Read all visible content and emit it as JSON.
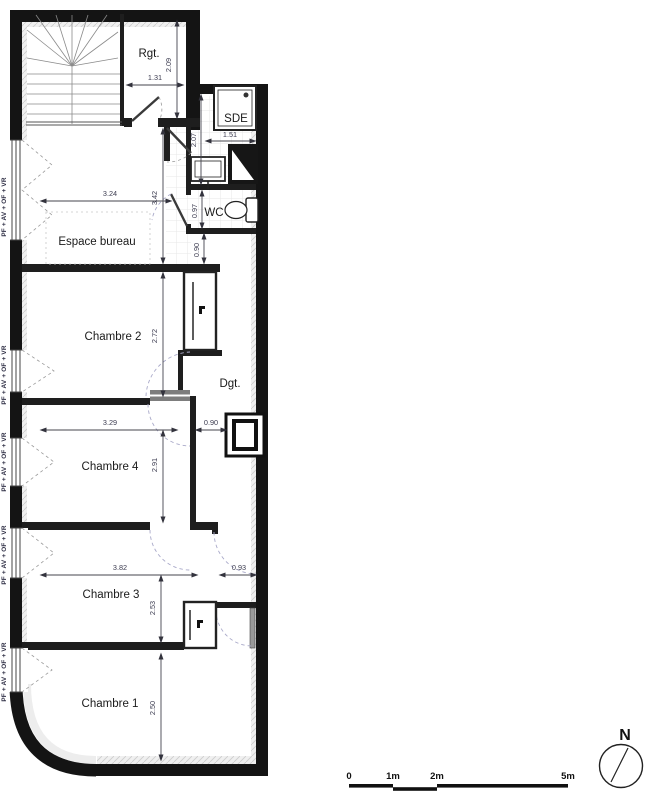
{
  "plan": {
    "room_labels": {
      "rgt": "Rgt.",
      "sde": "SDE",
      "wc": "WC",
      "bureau": "Espace bureau",
      "chambre2": "Chambre 2",
      "dgt": "Dgt.",
      "chambre4": "Chambre 4",
      "chambre3": "Chambre 3",
      "chambre1": "Chambre 1"
    },
    "dimensions": {
      "rgt_w": "1.31",
      "rgt_h": "2.09",
      "sde_h": "2.07",
      "sde_w": "1.51",
      "wc_h": "0.97",
      "bureau_w": "3.24",
      "bureau_h": "3.42",
      "hall_top": "0.90",
      "ch2_h": "2.72",
      "ch4_w": "3.29",
      "hall_mid": "0.90",
      "ch4_h": "2.91",
      "ch3_w": "3.82",
      "hall_low": "0.93",
      "ch3_h": "2.53",
      "ch1_h": "2.50"
    },
    "window_label": "PF + AV + OF + VR"
  },
  "scale_bar": {
    "tick0": "0",
    "tick1": "1m",
    "tick2": "2m",
    "tick5": "5m"
  },
  "compass": {
    "north": "N"
  },
  "colors": {
    "wall": "#141414",
    "dim_text": "#3c3c50",
    "door_arc": "#a9a9c9",
    "room_text": "#1a1a1a"
  }
}
